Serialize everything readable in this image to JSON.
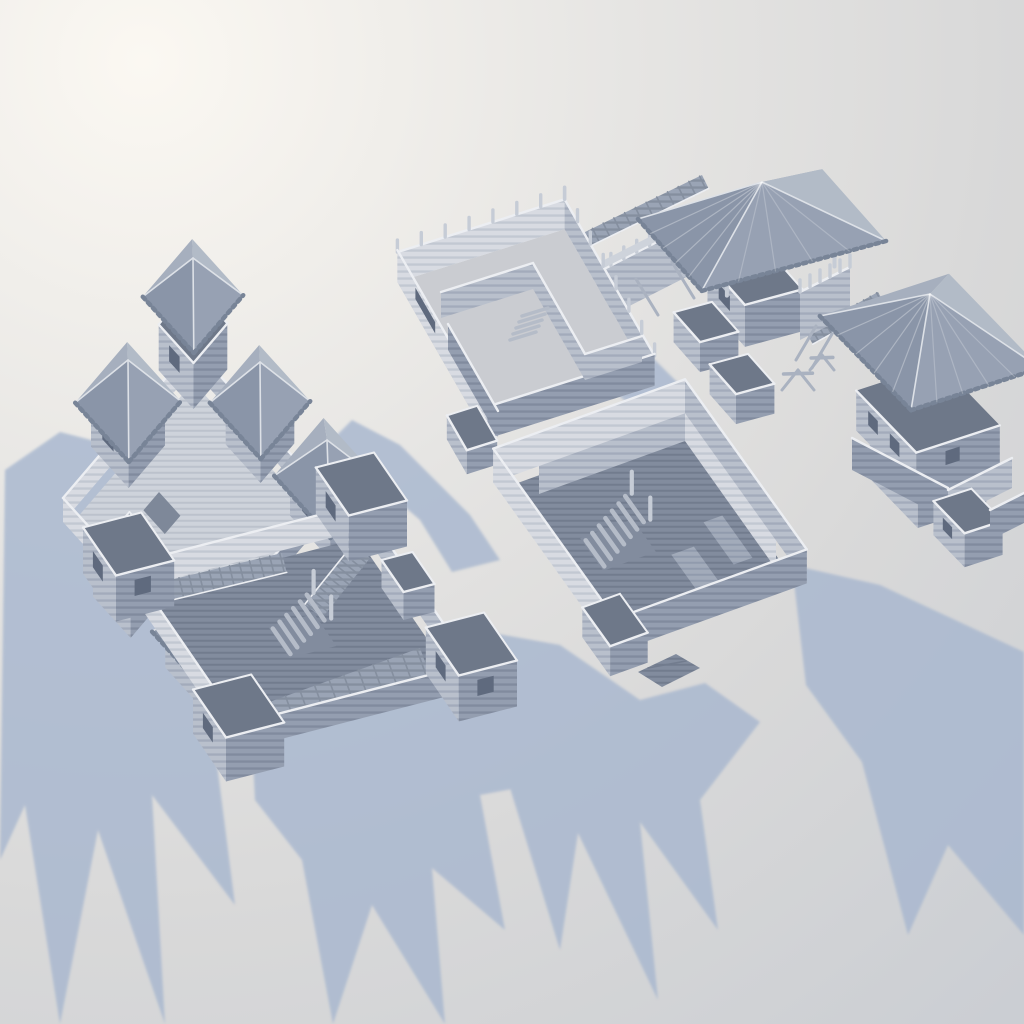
{
  "scene": {
    "title": "Modular wooden log fort terrain set — monochrome 3D render",
    "description": "High-angle 3D render of six unpainted modular log fort structures: a fort with pyramidal-roofed corner towers (one roof floating exploded above its tower), a roofless barracks enclosure with inner rooms, a raised gate rampart with a pyramidal canopy and detached plank ramp, a two-story blockhouse with a large overhanging pyramid roof, a large log enclosure with a freestanding interior staircase, and a fort with four open-top corner towers and interior log ramps. All pieces sit on a bright seamless studio backdrop, lit from the upper right, casting long jagged blue-gray shadows toward the lower left.",
    "style": "unpainted clay / resin miniature render, no text or UI",
    "light_direction": "upper right",
    "shadow_direction": "lower left"
  },
  "palette": {
    "bg_center": "#fbf8f2",
    "bg_mid": "#e6e5e3",
    "bg_outer": "#d9d9d9",
    "bg_edge": "#cbced3",
    "shadow": "#a8b7cf",
    "log_lit": "#d8dbe2",
    "log_lit_line": "#c2c8d2",
    "log_mid": "#b9c0cc",
    "log_mid_line": "#a3abbb",
    "log_dark": "#949eb0",
    "log_dark_line": "#818b9e",
    "plank_light": "#ced3db",
    "plank_light_line": "#bcc2cc",
    "plank_mid": "#a2abba",
    "plank_mid_line": "#919bad",
    "plank_dark": "#828c9e",
    "plank_dark_line": "#727c8e",
    "ramp": "#9aa4b5",
    "ramp_line": "#858f9f",
    "roof_nw": "#a6afbe",
    "roof_sw": "#8a95a8",
    "roof_se": "#97a1b3",
    "roof_ne": "#b2bbc7",
    "roof_ridge": "#dde1e7",
    "roof_edge": "#788497",
    "cap": "#eceef2",
    "interior": "#6e7889",
    "window": "#5f6a7e",
    "stud": "#c6ccd6",
    "stair": "#b5bcc8",
    "frame": "#aab2c0",
    "hatch": "#7e8899"
  },
  "modules": [
    {
      "name": "fort-roofed-towers",
      "position": "upper left",
      "features": [
        "five pyramidal tower roofs with crenellated eaves",
        "floating exploded roof above north tower",
        "light plank courtyard with dark hatch opening",
        "low log perimeter walls",
        "open-top corner tower with windows"
      ]
    },
    {
      "name": "fort-open-barracks",
      "position": "top middle",
      "features": [
        "roofless log enclosure",
        "inner partition walls forming corner rooms",
        "palisade studs standing on wall tops",
        "small interior ladder",
        "attached outer log crib"
      ]
    },
    {
      "name": "gate-rampart-with-canopy",
      "position": "upper right",
      "features": [
        "raised palisade wall with walkway",
        "detached floating plank ramp",
        "pyramidal gate canopy on corner posts",
        "two small open log cribs",
        "sawhorse trestles"
      ]
    },
    {
      "name": "two-story-blockhouse",
      "position": "right",
      "features": [
        "overhanging second story",
        "large pyramidal roof with rafters",
        "gun-port windows",
        "adjoining palisade section and braced walls",
        "low wall with window crib"
      ]
    },
    {
      "name": "fort-large-enclosure",
      "position": "center right",
      "features": [
        "tall log walls with inner parapet screens",
        "freestanding interior staircase with posts",
        "corner gate crib",
        "plank door lying on the ground",
        "dark plank floor"
      ]
    },
    {
      "name": "fort-corner-towers-ramps",
      "position": "lower left",
      "features": [
        "four open-top corner towers with windows",
        "interior log ramps descending from walls",
        "central staircase",
        "wide striped plank apron",
        "dark plank courtyard"
      ]
    }
  ]
}
